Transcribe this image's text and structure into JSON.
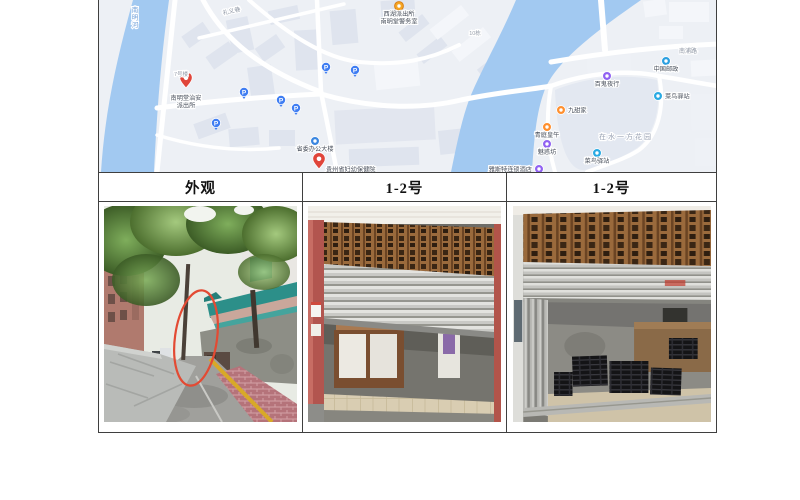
{
  "table": {
    "headers": [
      "外观",
      "1-2号",
      "1-2号"
    ]
  },
  "map": {
    "colors": {
      "background": "#edf0f5",
      "water": "#a2c9f1",
      "road": "#ffffff",
      "building": "#dfe4ee",
      "building_light": "#f4f6fa",
      "poi_text": "#474e5a",
      "road_text": "#8d95a3",
      "water_text": "#6f9fd8",
      "parking_blue": "#3f7df2"
    },
    "parking": [
      [
        117,
        123
      ],
      [
        145,
        92
      ],
      [
        182,
        100
      ],
      [
        197,
        108
      ],
      [
        227,
        67
      ],
      [
        256,
        70
      ]
    ],
    "pois": [
      {
        "type": "pin",
        "color": "#e0453a",
        "x": 87,
        "y": 88,
        "lines": [
          "南明堂治安",
          "派出所"
        ],
        "lpos": "below"
      },
      {
        "type": "badge",
        "color": "#f6a623",
        "x": 300,
        "y": 6,
        "lines": [
          "西湖派出所",
          "南明堂警务室"
        ],
        "lpos": "below"
      },
      {
        "type": "circle",
        "color": "#3a86e0",
        "x": 216,
        "y": 141,
        "lines": [
          "省委办公大楼"
        ],
        "lpos": "below"
      },
      {
        "type": "pin",
        "color": "#e0453a",
        "x": 220,
        "y": 169,
        "lines": [
          "贵州省妇幼保健院"
        ],
        "lpos": "right"
      },
      {
        "type": "circle",
        "color": "#9061f2",
        "x": 508,
        "y": 76,
        "lines": [
          "百鬼夜行"
        ],
        "lpos": "below"
      },
      {
        "type": "circle",
        "color": "#ff8f2e",
        "x": 462,
        "y": 110,
        "lines": [
          "九甜家"
        ],
        "lpos": "right"
      },
      {
        "type": "circle",
        "color": "#ff8f2e",
        "x": 448,
        "y": 127,
        "lines": [
          "青庭皇午"
        ],
        "lpos": "below"
      },
      {
        "type": "circle",
        "color": "#9061f2",
        "x": 448,
        "y": 144,
        "lines": [
          "魅惑坊"
        ],
        "lpos": "below"
      },
      {
        "type": "circle",
        "color": "#9061f2",
        "x": 440,
        "y": 169,
        "lines": [
          "雅斯特连锁酒店"
        ],
        "lpos": "left"
      },
      {
        "type": "circle",
        "color": "#29aae3",
        "x": 559,
        "y": 96,
        "lines": [
          "菜鸟驿站"
        ],
        "lpos": "right"
      },
      {
        "type": "circle",
        "color": "#2b9fe0",
        "x": 567,
        "y": 61,
        "lines": [
          "中国邮政"
        ],
        "lpos": "below"
      },
      {
        "type": "circle",
        "color": "#29aae3",
        "x": 498,
        "y": 153,
        "lines": [
          "菜鸟驿站"
        ],
        "lpos": "below"
      }
    ],
    "labels": [
      {
        "text": "南明河",
        "x": 36,
        "y": 12,
        "color": "#6f9fd8",
        "size": 6.5,
        "vertical": true
      },
      {
        "text": "在水一方花园",
        "x": 527,
        "y": 139,
        "color": "#99a2b3",
        "size": 7,
        "spacing": 2
      },
      {
        "text": "南浦路",
        "x": 589,
        "y": 53,
        "color": "#8d95a3",
        "size": 6
      },
      {
        "text": "礼义巷",
        "x": 133,
        "y": 13,
        "color": "#8d95a3",
        "size": 6,
        "rotate": -13
      },
      {
        "text": "10栋",
        "x": 376,
        "y": 35,
        "color": "#9aa1ad",
        "size": 5.5
      },
      {
        "text": "7号楼",
        "x": 82,
        "y": 76,
        "color": "#9aa1ad",
        "size": 5.5
      }
    ]
  },
  "photos": [
    {
      "name": "alley-exterior",
      "annotation_color": "#e34a33"
    },
    {
      "name": "shop-unit-1-2-closed"
    },
    {
      "name": "shop-unit-1-2-open"
    }
  ]
}
